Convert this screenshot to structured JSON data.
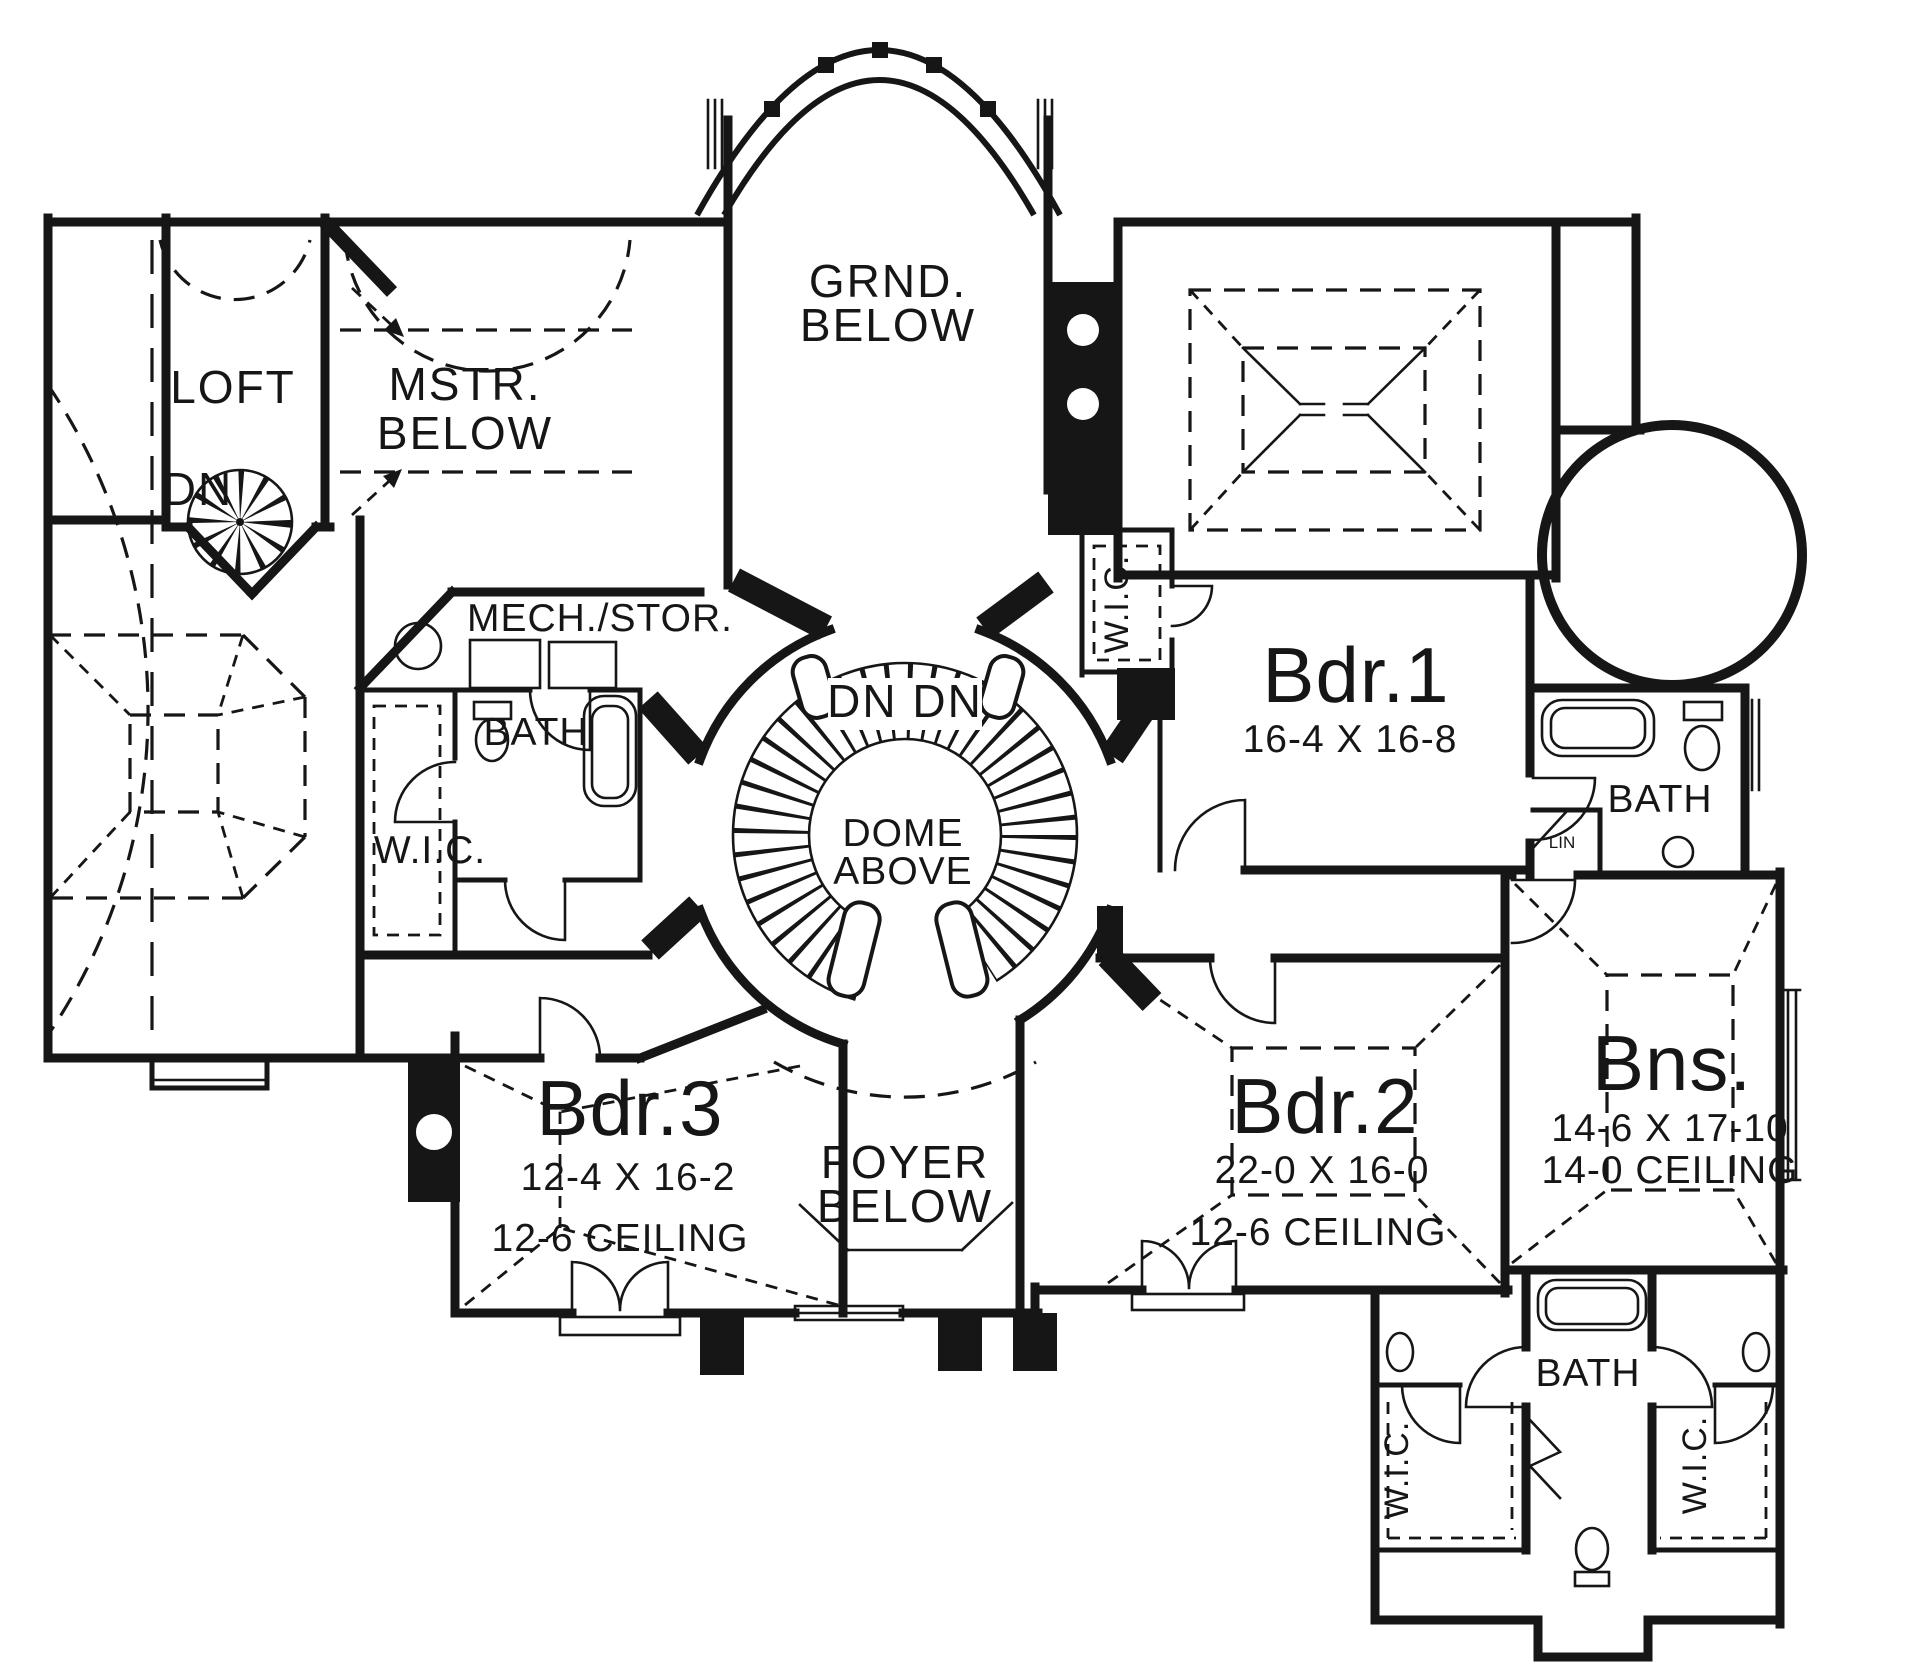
{
  "drawing": {
    "ink_color": "#161616",
    "paper_color": "#ffffff"
  },
  "rooms": {
    "loft": {
      "name": "LOFT"
    },
    "master_below": {
      "line1": "MSTR.",
      "line2": "BELOW"
    },
    "grand_below": {
      "line1": "GRND.",
      "line2": "BELOW"
    },
    "mech_storage": {
      "name": "MECH./STOR."
    },
    "bath_upper_left": {
      "name": "BATH"
    },
    "wic_upper_left": {
      "name": "W.I.C."
    },
    "wic_center": {
      "name": "W.I.C."
    },
    "bedroom_1": {
      "name": "Bdr.1",
      "size": "16-4 X 16-8"
    },
    "bath_right": {
      "name": "BATH"
    },
    "linen": {
      "name": "LIN"
    },
    "bedroom_3": {
      "name": "Bdr.3",
      "size": "12-4 X 16-2",
      "ceiling": "12-6 CEILING"
    },
    "foyer_below": {
      "line1": "FOYER",
      "line2": "BELOW"
    },
    "bedroom_2": {
      "name": "Bdr.2",
      "size": "22-0 X 16-0",
      "ceiling": "12-6 CEILING"
    },
    "bonus": {
      "name": "Bns.",
      "size": "14-6 X 17-10",
      "ceiling": "14-0 CEILING"
    },
    "bath_bottom": {
      "name": "BATH"
    },
    "wic_bottom_left": {
      "name": "W.I.C."
    },
    "wic_bottom_right": {
      "name": "W.I.C."
    }
  },
  "stairs": {
    "spiral_down": "DN",
    "main_down": "DN DN",
    "dome_line1": "DOME",
    "dome_line2": "ABOVE"
  }
}
